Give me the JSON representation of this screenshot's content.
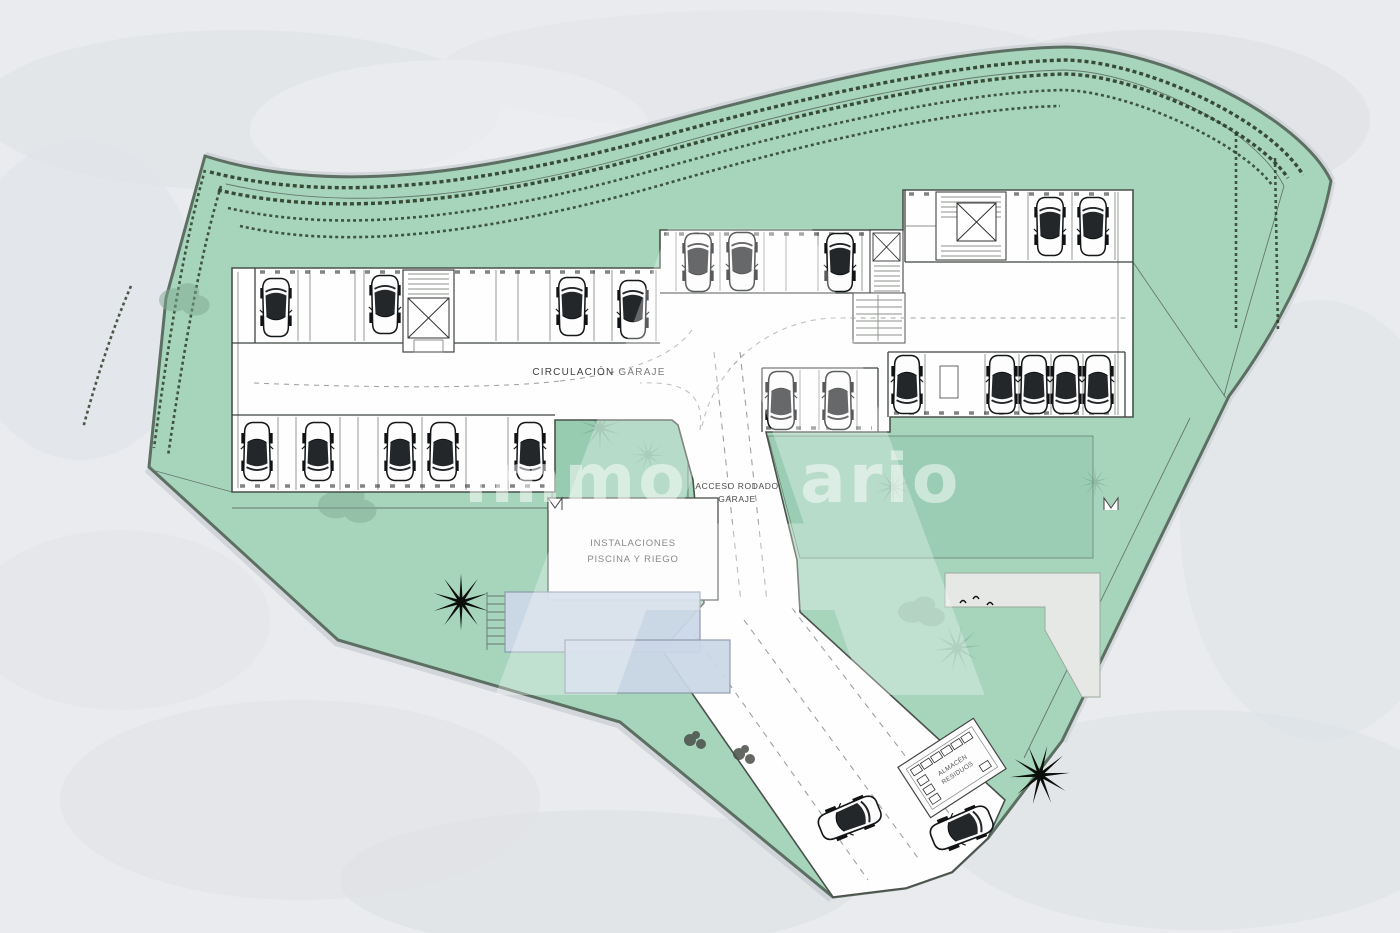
{
  "plan": {
    "labels": {
      "circulation": "CIRCULACIÓN GARAJE",
      "access_line1": "ACCESO RODADO",
      "access_line2": "GARAJE",
      "installations_line1": "INSTALACIONES",
      "installations_line2": "PISCINA Y RIEGO",
      "waste_line1": "ALMACÉN",
      "waste_line2": "RESIDUOS"
    },
    "watermark": {
      "left": "immo",
      "big_letter": "A",
      "right": "ario"
    },
    "colors": {
      "background_gray": "#e9ebee",
      "site_green": "#a7d5bc",
      "terrace_green": "#97ccb1",
      "site_outline": "#5d6f63",
      "hedge_dark": "#26331f",
      "plate_white": "#fefefe",
      "line_dark": "#3f4540",
      "pool_blue": "#ccd8e8",
      "paving_gray": "#e5e8e4",
      "palm_black": "#0b0e0b",
      "watermark_white": "#ffffff"
    }
  }
}
